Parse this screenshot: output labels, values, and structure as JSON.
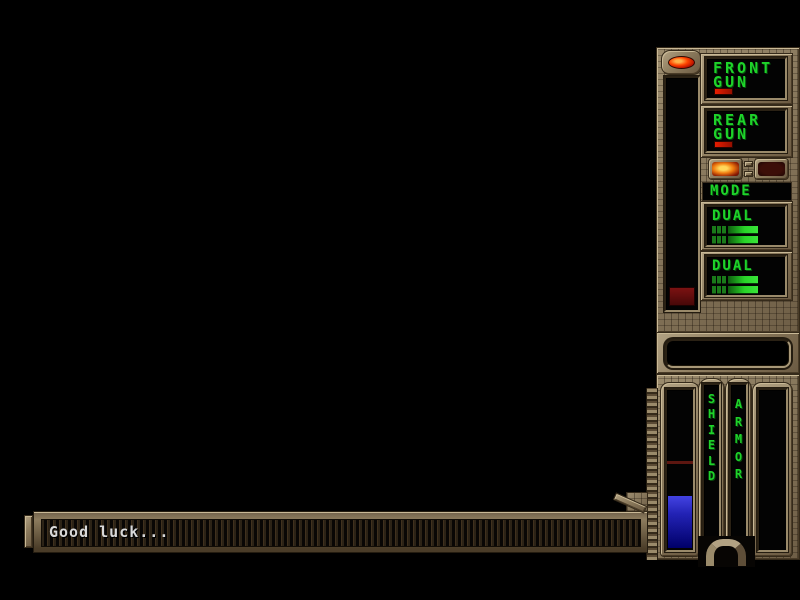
{
  "hud": {
    "front_gun": {
      "line1": "FRONT",
      "line2": "GUN"
    },
    "rear_gun": {
      "line1": "REAR",
      "line2": "GUN"
    },
    "mode_label": "MODE",
    "dual_top_label": "DUAL",
    "dual_bottom_label": "DUAL",
    "shield_letters": [
      "S",
      "H",
      "I",
      "E",
      "L",
      "D"
    ],
    "armor_letters": [
      "A",
      "R",
      "M",
      "O",
      "R"
    ],
    "score_display": "",
    "message": "Good luck..."
  },
  "colors": {
    "hud_green": "#1ed32a",
    "ammo_red": "#d81800",
    "shield_blue": "#2424c8",
    "panel_bronze": "#8d7c5e",
    "mode_button_lit": "#ffd75a",
    "mode_button_unlit": "#3c0e08",
    "led_red": "#ff4400",
    "message_text": "#d9d9d9",
    "background": "#000000"
  }
}
